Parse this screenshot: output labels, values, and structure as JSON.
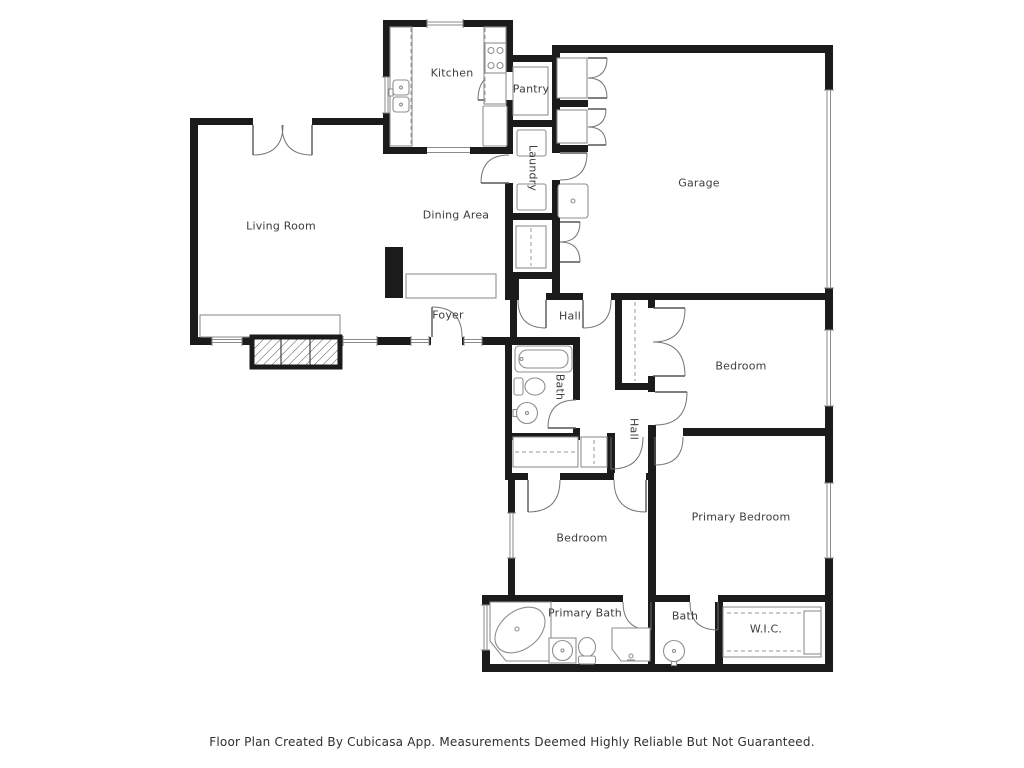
{
  "page": {
    "background": "#ffffff"
  },
  "colors": {
    "wall": "#1b1b1b",
    "fixture": "#8f8f8f",
    "door": "#757575",
    "label": "#3d3d3d"
  },
  "floor_plan": {
    "rooms": [
      {
        "id": "kitchen",
        "label": "Kitchen",
        "x": 452,
        "y": 73,
        "rotate": 0
      },
      {
        "id": "pantry",
        "label": "Pantry",
        "x": 531,
        "y": 89,
        "rotate": 0
      },
      {
        "id": "laundry",
        "label": "Laundry",
        "x": 533,
        "y": 168,
        "rotate": 90
      },
      {
        "id": "garage",
        "label": "Garage",
        "x": 699,
        "y": 183,
        "rotate": 0
      },
      {
        "id": "living-room",
        "label": "Living Room",
        "x": 281,
        "y": 226,
        "rotate": 0
      },
      {
        "id": "dining-area",
        "label": "Dining Area",
        "x": 456,
        "y": 215,
        "rotate": 0
      },
      {
        "id": "foyer",
        "label": "Foyer",
        "x": 448,
        "y": 315,
        "rotate": 0
      },
      {
        "id": "hall-upper",
        "label": "Hall",
        "x": 570,
        "y": 316,
        "rotate": 0
      },
      {
        "id": "bath-middle",
        "label": "Bath",
        "x": 560,
        "y": 387,
        "rotate": 90
      },
      {
        "id": "bedroom-upper",
        "label": "Bedroom",
        "x": 741,
        "y": 366,
        "rotate": 0
      },
      {
        "id": "hall-lower",
        "label": "Hall",
        "x": 634,
        "y": 429,
        "rotate": 90
      },
      {
        "id": "primary-bedroom",
        "label": "Primary Bedroom",
        "x": 741,
        "y": 517,
        "rotate": 0
      },
      {
        "id": "bedroom-lower",
        "label": "Bedroom",
        "x": 582,
        "y": 538,
        "rotate": 0
      },
      {
        "id": "primary-bath",
        "label": "Primary Bath",
        "x": 585,
        "y": 613,
        "rotate": 0
      },
      {
        "id": "bath-lower",
        "label": "Bath",
        "x": 685,
        "y": 616,
        "rotate": 0
      },
      {
        "id": "wic",
        "label": "W.I.C.",
        "x": 766,
        "y": 629,
        "rotate": 0
      }
    ],
    "footer": {
      "text": "Floor Plan Created By Cubicasa App. Measurements Deemed Highly Reliable But Not Guaranteed."
    }
  }
}
